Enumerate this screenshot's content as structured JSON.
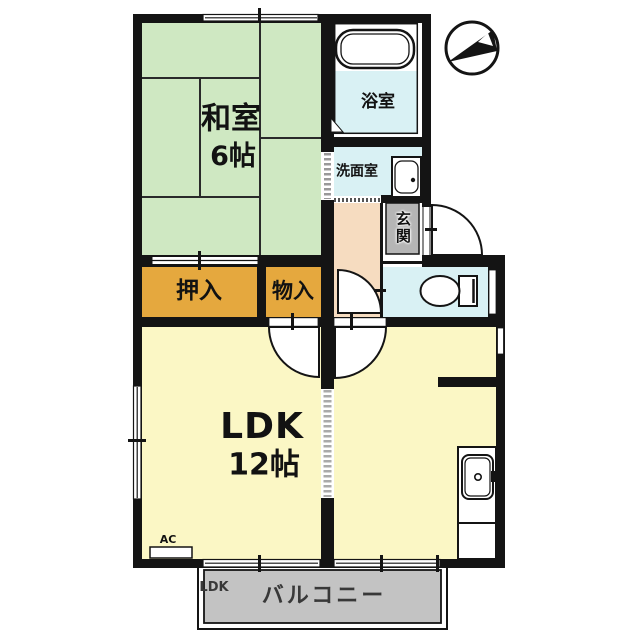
{
  "plan": {
    "rooms": {
      "washitsu": {
        "label": "和室",
        "size": "6帖"
      },
      "bath": {
        "label": "浴室"
      },
      "washroom": {
        "label": "洗面室"
      },
      "entrance": {
        "label": "玄関"
      },
      "closet": {
        "label": "押入"
      },
      "storage": {
        "label": "物入"
      },
      "ldk": {
        "label": "LDK",
        "size": "12帖"
      },
      "balcony": {
        "label": "バルコニー",
        "access_tag": "LDK"
      },
      "ac_label": "AC"
    },
    "icons": {
      "compass": "north-arrow-compass",
      "bathtub": "bathtub",
      "toilet": "toilet",
      "washbasin": "washbasin",
      "kitchen_sink": "kitchen-sink"
    },
    "colors": {
      "wall": "#141414",
      "tatami": "#cfe8c2",
      "closet": "#e5a83e",
      "ldk": "#fbf7c5",
      "wet_area": "#d9f1f4",
      "hallway": "#f6dcc0",
      "entrance_floor": "#b5b5b5",
      "balcony": "#c3c3c3",
      "background": "#ffffff"
    }
  }
}
